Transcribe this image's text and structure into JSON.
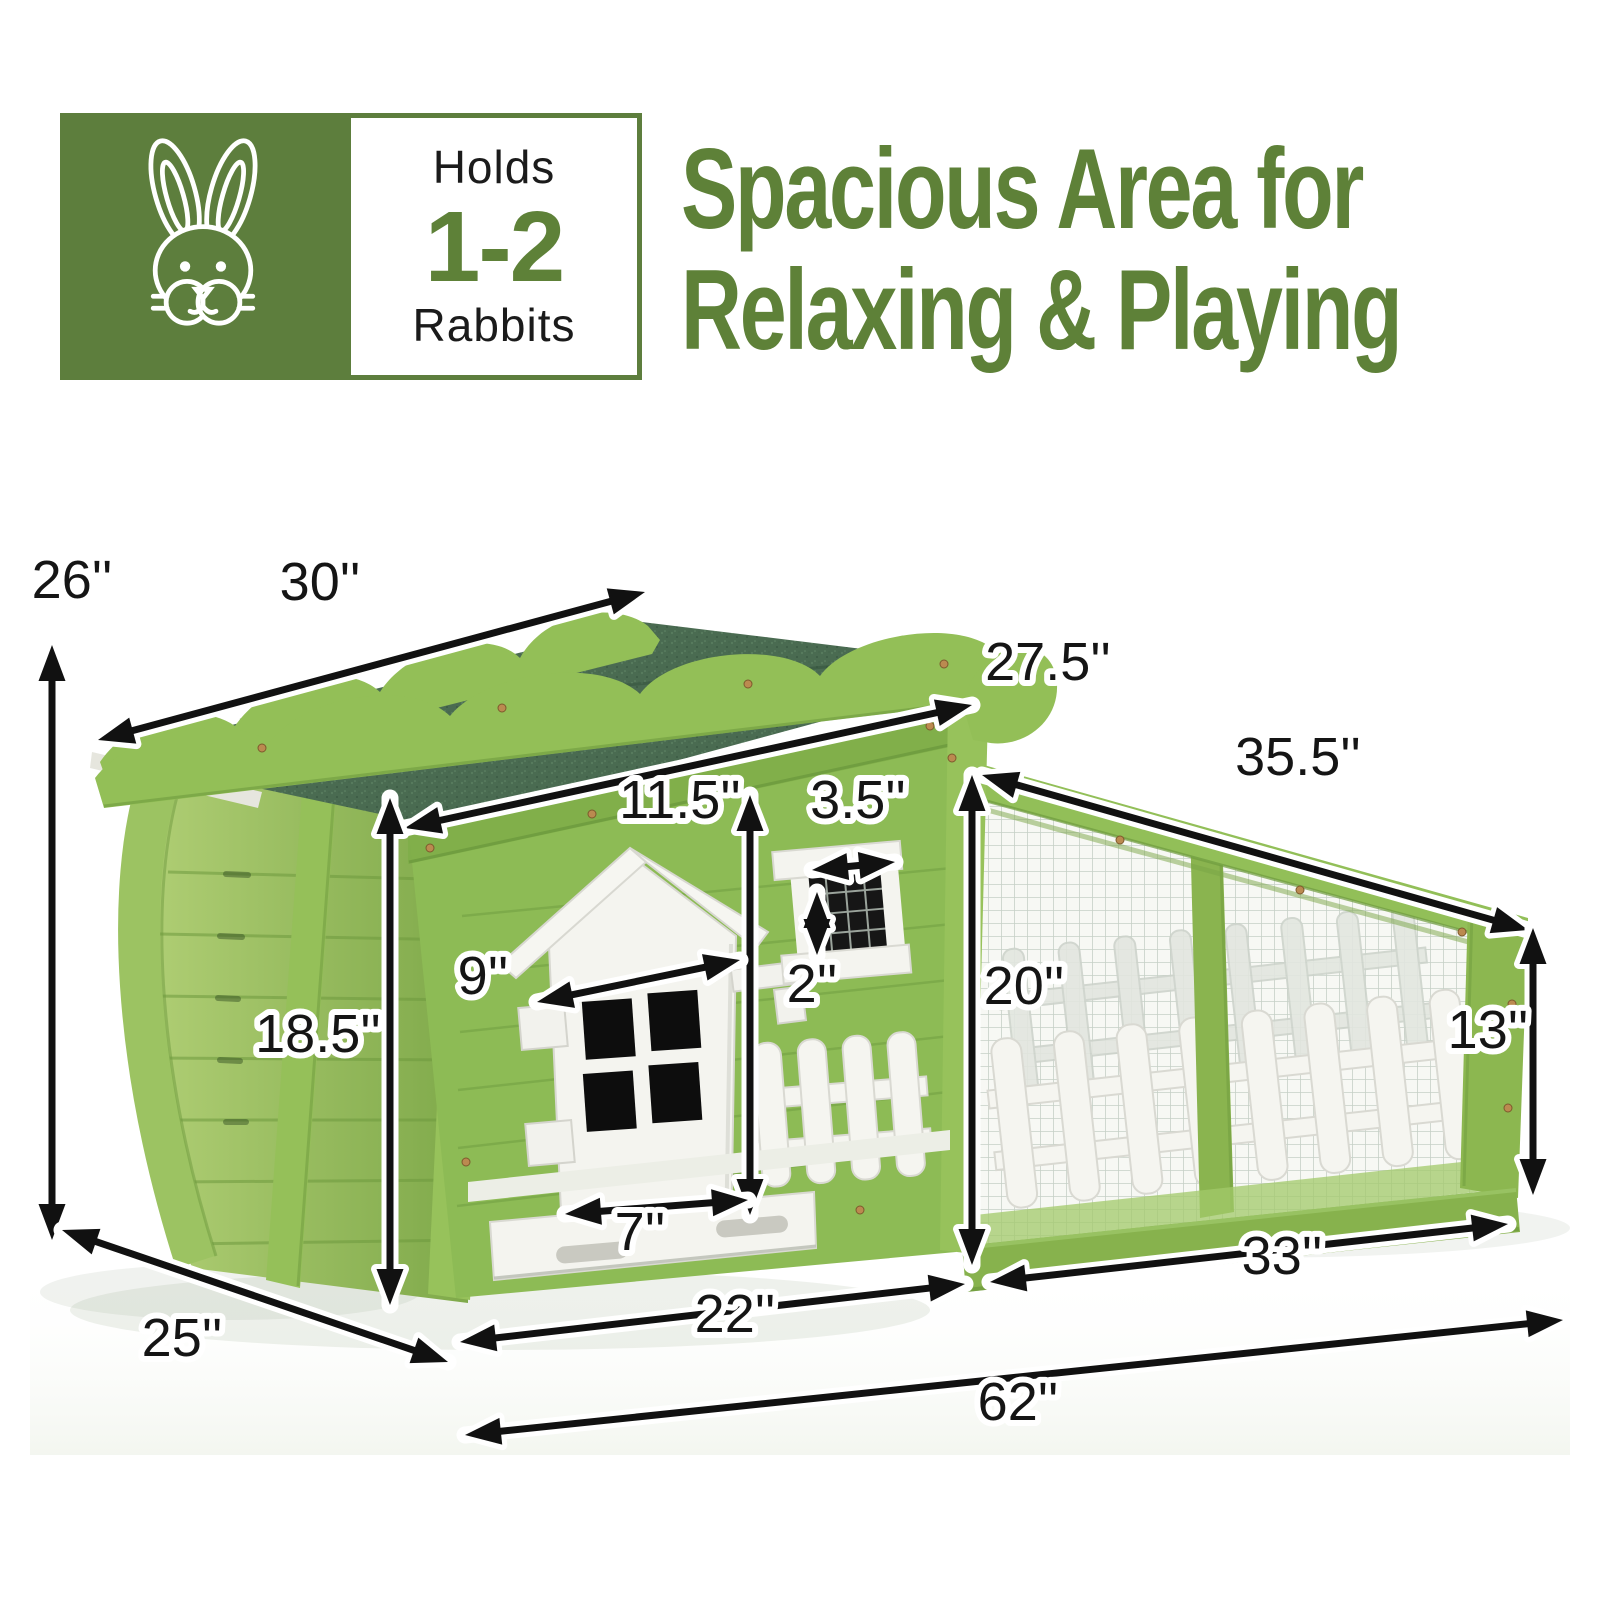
{
  "page": {
    "background": "#ffffff"
  },
  "capacity_badge": {
    "icon": "rabbit-icon",
    "bg_color": "#5d7e3d",
    "line1": "Holds",
    "line2": "1-2",
    "line3": "Rabbits",
    "accent_color": "#5e8138"
  },
  "headline": {
    "line1": "Spacious Area for",
    "line2": "Relaxing & Playing",
    "color": "#5e8138"
  },
  "illustration": {
    "name": "rabbit-hutch-with-run",
    "roof_color": "#4a6b51",
    "wood_color": "#8dbb55",
    "trim_color": "#93bf57",
    "white_color": "#f4f4ef"
  },
  "dimensions": [
    {
      "id": "height-left",
      "label": "26''"
    },
    {
      "id": "roof-depth",
      "label": "30''"
    },
    {
      "id": "roof-width",
      "label": "27.5''"
    },
    {
      "id": "run-roof-length",
      "label": "35.5''"
    },
    {
      "id": "door-opening-height",
      "label": "11.5''"
    },
    {
      "id": "window-width",
      "label": "3.5''"
    },
    {
      "id": "window-height",
      "label": "2''"
    },
    {
      "id": "door-width-diagonal",
      "label": "9''"
    },
    {
      "id": "run-height-left",
      "label": "20''"
    },
    {
      "id": "run-height-right",
      "label": "13''"
    },
    {
      "id": "house-height",
      "label": "18.5''"
    },
    {
      "id": "door-bottom-width",
      "label": "7''"
    },
    {
      "id": "house-base-width",
      "label": "22''"
    },
    {
      "id": "run-base-width",
      "label": "33''"
    },
    {
      "id": "house-depth",
      "label": "25''"
    },
    {
      "id": "total-length",
      "label": "62''"
    }
  ]
}
